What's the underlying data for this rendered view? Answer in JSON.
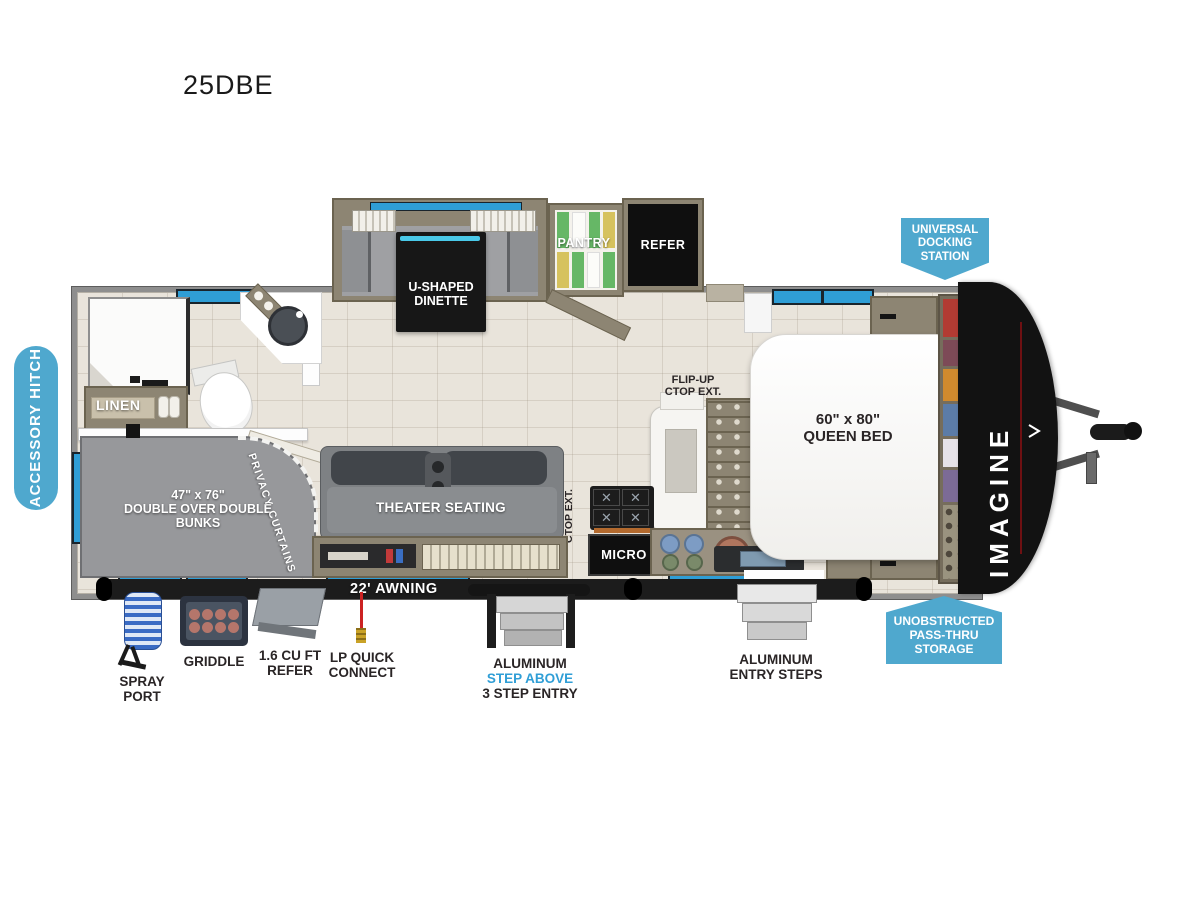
{
  "title": "25DBE",
  "brand": "IMAGINE",
  "colors": {
    "badge_blue": "#4fa8ce",
    "window_blue": "#2f9ed6",
    "step_above_blue": "#2f9ed6",
    "cabinet_tan": "#8d8573",
    "front_cap_black": "#121212"
  },
  "badges": {
    "accessory_hitch": "ACCESSORY HITCH",
    "universal_docking": {
      "l1": "UNIVERSAL",
      "l2": "DOCKING",
      "l3": "STATION"
    },
    "pass_thru": {
      "l1": "UNOBSTRUCTED",
      "l2": "PASS-THRU",
      "l3": "STORAGE"
    }
  },
  "rooms": {
    "dinette": {
      "l1": "U-SHAPED",
      "l2": "DINETTE"
    },
    "pantry": "PANTRY",
    "refer": "REFER",
    "linen": "LINEN",
    "bunks": {
      "l1": "47\" x 76\"",
      "l2": "DOUBLE OVER DOUBLE",
      "l3": "BUNKS"
    },
    "privacy_curtains": "PRIVACY CURTAINS",
    "theater": "THEATER SEATING",
    "micro": "MICRO",
    "queen": {
      "l1": "60\" x 80\"",
      "l2": "QUEEN BED"
    },
    "flip_up": {
      "l1": "FLIP-UP",
      "l2": "CTOP EXT."
    },
    "awning": "22' AWNING"
  },
  "exterior": {
    "spray_port": {
      "l1": "SPRAY",
      "l2": "PORT"
    },
    "griddle": "GRIDDLE",
    "mini_refer": {
      "l1": "1.6 CU FT",
      "l2": "REFER"
    },
    "lp": {
      "l1": "LP QUICK",
      "l2": "CONNECT"
    },
    "step3": {
      "l1": "ALUMINUM",
      "l2": "STEP ABOVE",
      "l3": "3 STEP ENTRY"
    },
    "entry_steps": {
      "l1": "ALUMINUM",
      "l2": "ENTRY STEPS"
    }
  }
}
